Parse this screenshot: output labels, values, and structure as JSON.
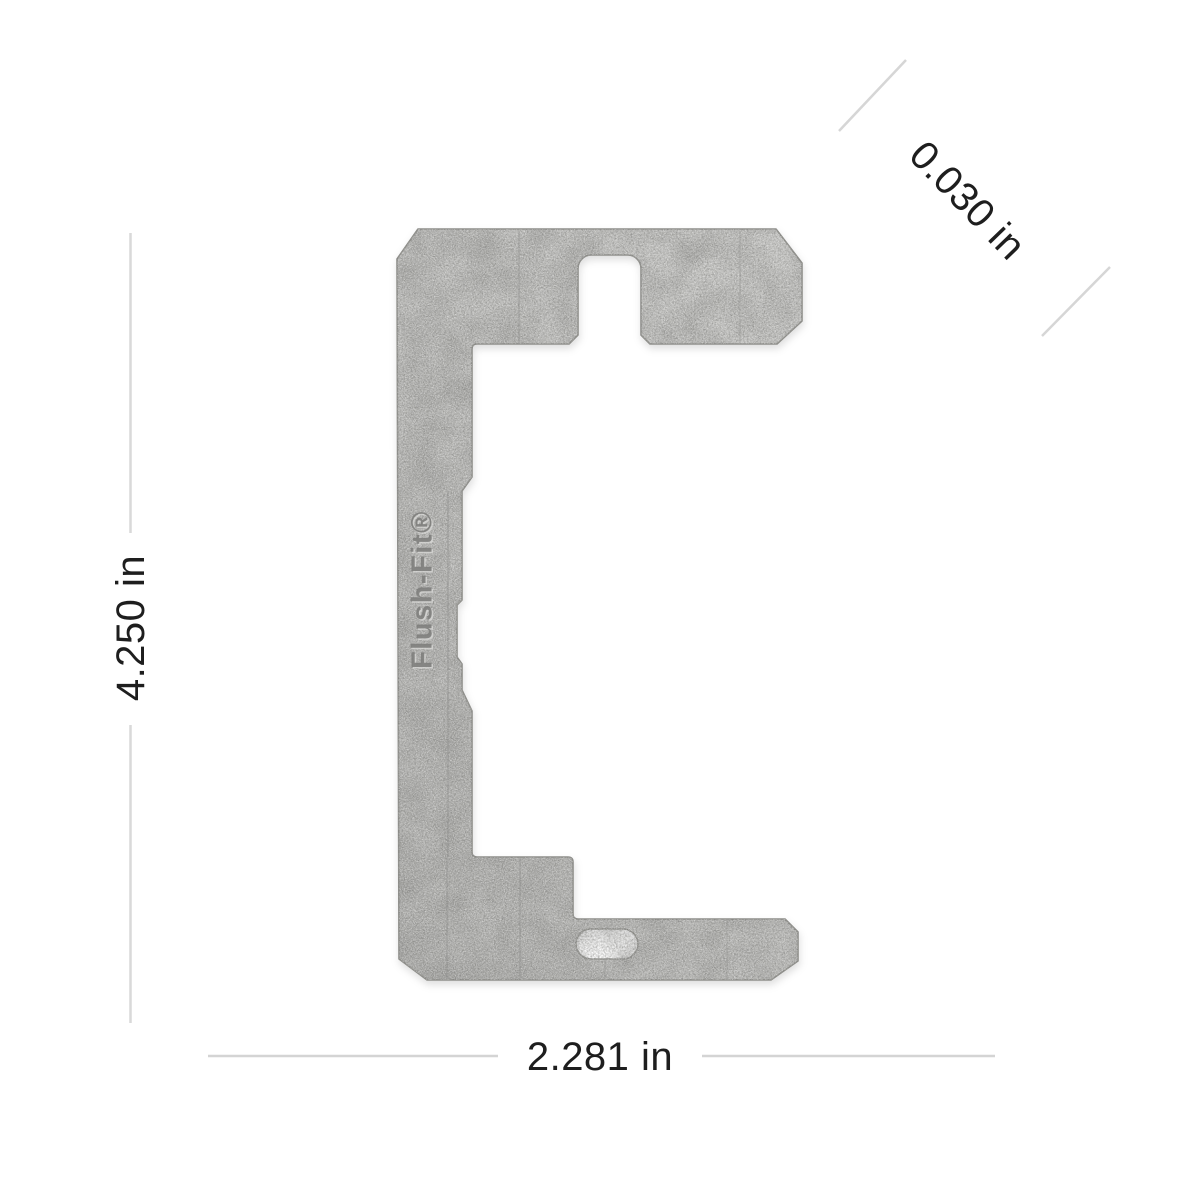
{
  "diagram": {
    "type": "product-dimension-diagram",
    "product": "metal wall plate leveler bracket",
    "brand_text": "Flush-Fit®",
    "dimensions": {
      "height_label": "4.250 in",
      "width_label": "2.281 in",
      "thickness_label": "0.030 in"
    }
  },
  "colors": {
    "background": "#ffffff",
    "plate_light": "#c9c9c7",
    "plate_dark": "#b2b2b0",
    "plate_edge": "#8e8e8a",
    "score_line": "#8f8f8d",
    "dimension_line": "#d6d6d6",
    "dimension_text": "#1e1e1e",
    "brand_text_color": "#7e7e7c"
  }
}
